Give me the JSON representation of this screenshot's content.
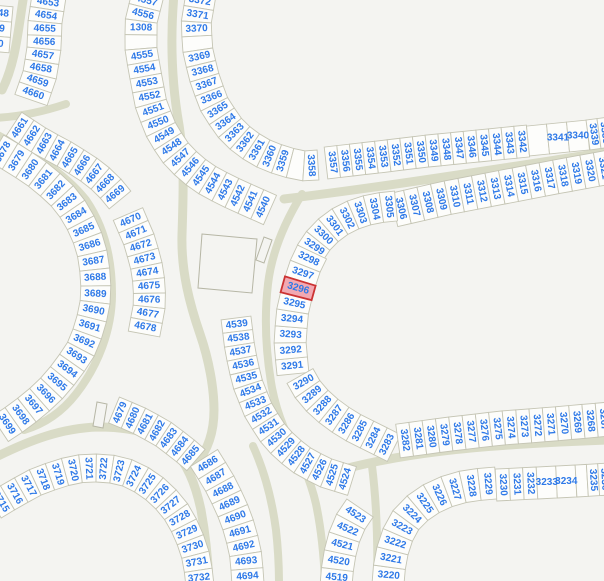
{
  "map": {
    "width": 604,
    "height": 581,
    "background": "#f4f4f1",
    "road_color": "#d9dbc6",
    "parcel_fill": "#fdfdfb",
    "parcel_stroke": "#c5c5b4",
    "label_color": "#2e79e8",
    "label_font_size": 10,
    "highlight": {
      "label": "3296",
      "fill": "#f2a9b2",
      "stroke": "#cc3333"
    },
    "structures": [
      {
        "name": "building-large",
        "points": "202,234 257,239 252,293 198,288"
      },
      {
        "name": "building-small-1",
        "points": "272,240 264,237 256,260 264,263"
      },
      {
        "name": "building-small-2",
        "points": "103,428 93,426 97,402 107,404"
      }
    ],
    "roads": [
      {
        "d": "M 24 -6 C 18 30 16 62 2 90",
        "w": 9
      },
      {
        "d": "M 66 104 C 42 112 18 117 -6 118",
        "w": 8
      },
      {
        "d": "M -8 132 C 30 152 64 172 86 200 C 104 226 112 258 112 294 C 112 330 98 366 76 394 C 62 412 44 424 24 430",
        "w": 8
      },
      {
        "d": "M -6 458 C 30 440 62 428 98 427 C 134 427 158 434 174 450 C 188 465 196 486 201 510 C 205 532 208 558 209 584",
        "w": 9
      },
      {
        "d": "M 253 446 C 264 470 272 500 276 530 C 278 548 279 566 279 584",
        "w": 8
      },
      {
        "d": "M 174 -6 C 170 40 172 85 179 125 C 185 163 183 200 182 235 C 181 272 190 305 200 334 C 209 360 214 388 214 410 C 214 432 208 450 196 464",
        "w": 9
      },
      {
        "d": "M 302 194 C 286 220 272 250 268 284 C 264 318 266 354 272 388 C 277 414 288 442 304 462 C 312 472 322 476 332 474",
        "w": 8
      },
      {
        "d": "M 326 474 C 400 452 480 446 560 442 L 608 440",
        "w": 9
      },
      {
        "d": "M 290 438 C 300 458 310 478 316 504 C 321 528 324 556 325 584",
        "w": 8
      },
      {
        "d": "M 372 466 C 376 498 378 540 377 584",
        "w": 8
      },
      {
        "d": "M 284 199 C 390 186 490 170 608 152",
        "w": 9
      }
    ],
    "rows": [
      {
        "name": "row-left-cut",
        "spine": [
          [
            4,
            6
          ],
          [
            0,
            52
          ]
        ],
        "hw": 9,
        "labels": [
          "48",
          "9",
          "0"
        ]
      },
      {
        "name": "row-4653-4660",
        "spine": [
          [
            49,
            -4
          ],
          [
            45,
            22
          ],
          [
            44,
            48
          ],
          [
            40,
            74
          ],
          [
            31,
            100
          ]
        ],
        "hw": 17,
        "labels": [
          "4653",
          "4654",
          "4655",
          "4656",
          "4657",
          "4658",
          "4659",
          "4660"
        ]
      },
      {
        "name": "row-4661-4669",
        "spine": [
          [
            14,
            124
          ],
          [
            40,
            141
          ],
          [
            66,
            155
          ],
          [
            88,
            169
          ],
          [
            106,
            183
          ],
          [
            120,
            200
          ]
        ],
        "hw": 14,
        "labels": [
          "4661",
          "4662",
          "4663",
          "4664",
          "4665",
          "4666",
          "4667",
          "4668",
          "4669"
        ]
      },
      {
        "name": "row-4670-4678",
        "spine": [
          [
            128,
            214
          ],
          [
            140,
            242
          ],
          [
            148,
            272
          ],
          [
            150,
            302
          ],
          [
            144,
            334
          ]
        ],
        "hw": 16,
        "labels": [
          "4670",
          "4671",
          "4672",
          "4673",
          "4674",
          "4675",
          "4676",
          "4677",
          "4678"
        ]
      },
      {
        "name": "row-4679-4685",
        "spine": [
          [
            114,
            410
          ],
          [
            138,
            420
          ],
          [
            162,
            433
          ],
          [
            182,
            448
          ],
          [
            196,
            460
          ]
        ],
        "hw": 14,
        "labels": [
          "4679",
          "4680",
          "4681",
          "4682",
          "4683",
          "4684",
          "4685"
        ]
      },
      {
        "name": "row-4686-4694",
        "spine": [
          [
            204,
            458
          ],
          [
            219,
            482
          ],
          [
            231,
            506
          ],
          [
            240,
            530
          ],
          [
            246,
            556
          ],
          [
            248,
            584
          ]
        ],
        "hw": 16,
        "labels": [
          "4686",
          "4687",
          "4688",
          "4689",
          "4690",
          "4691",
          "4692",
          "4693",
          "4694"
        ]
      },
      {
        "name": "row-4540-4557",
        "spine": [
          [
            148,
            -6
          ],
          [
            141,
            22
          ],
          [
            141,
            50
          ],
          [
            146,
            78
          ],
          [
            151,
            104
          ],
          [
            160,
            128
          ],
          [
            173,
            150
          ],
          [
            190,
            168
          ],
          [
            210,
            182
          ],
          [
            232,
            193
          ],
          [
            252,
            202
          ],
          [
            270,
            210
          ]
        ],
        "hw": 16,
        "labels": [
          "4557",
          "4556",
          "1308",
          "",
          "4555",
          "4554",
          "4553",
          "4552",
          "4551",
          "4550",
          "4549",
          "4548",
          "4547",
          "4546",
          "4545",
          "4544",
          "4543",
          "4542",
          "4541",
          "4540"
        ]
      },
      {
        "name": "row-3358-3372",
        "spine": [
          [
            201,
            -6
          ],
          [
            196,
            24
          ],
          [
            198,
            52
          ],
          [
            205,
            80
          ],
          [
            214,
            104
          ],
          [
            228,
            126
          ],
          [
            244,
            142
          ],
          [
            262,
            153
          ],
          [
            282,
            161
          ],
          [
            302,
            166
          ],
          [
            318,
            165
          ]
        ],
        "hw": 15,
        "labels": [
          "3372",
          "3371",
          "3370",
          "",
          "3369",
          "3368",
          "3367",
          "3366",
          "3365",
          "3364",
          "3363",
          "3362",
          "3361",
          "3360",
          "3359",
          "",
          "3358"
        ]
      },
      {
        "name": "row-3342-3357",
        "spine": [
          [
            326,
            163
          ],
          [
            378,
            157
          ],
          [
            428,
            151
          ],
          [
            478,
            146
          ],
          [
            528,
            141
          ]
        ],
        "hw": 16,
        "labels": [
          "3357",
          "3356",
          "3355",
          "3354",
          "3353",
          "3352",
          "3351",
          "3350",
          "3349",
          "3348",
          "3347",
          "3346",
          "3345",
          "3344",
          "3343",
          "3342"
        ]
      },
      {
        "name": "row-3340-3341",
        "spine": [
          [
            528,
            141
          ],
          [
            588,
            135
          ]
        ],
        "hw": 15,
        "labelAngle": 0,
        "labels": [
          "",
          "3341",
          "3340"
        ]
      },
      {
        "name": "row-3338-3339",
        "spine": [
          [
            588,
            135
          ],
          [
            610,
            132
          ]
        ],
        "hw": 15,
        "labels": [
          "3339",
          "3338"
        ]
      },
      {
        "name": "row-3306-3321",
        "spine": [
          [
            394,
            210
          ],
          [
            446,
            198
          ],
          [
            498,
            188
          ],
          [
            550,
            178
          ],
          [
            610,
            167
          ]
        ],
        "hw": 17,
        "labels": [
          "3306",
          "3307",
          "3308",
          "3309",
          "3310",
          "3311",
          "3312",
          "3313",
          "3314",
          "3315",
          "3316",
          "3317",
          "3318",
          "3319",
          "3320",
          "3321"
        ]
      },
      {
        "name": "row-3299-3305",
        "spine": [
          [
            310,
            253
          ],
          [
            320,
            238
          ],
          [
            334,
            225
          ],
          [
            350,
            216
          ],
          [
            368,
            210
          ],
          [
            384,
            207
          ],
          [
            396,
            206
          ]
        ],
        "hw": 15,
        "labels": [
          "3299",
          "3300",
          "3301",
          "3302",
          "3303",
          "3304",
          "3305"
        ]
      },
      {
        "name": "row-3291-3298",
        "spine": [
          [
            293,
            374
          ],
          [
            290,
            344
          ],
          [
            292,
            314
          ],
          [
            298,
            288
          ],
          [
            306,
            264
          ],
          [
            312,
            252
          ]
        ],
        "hw": 16,
        "labels": [
          "3291",
          "3292",
          "3293",
          "3294",
          "3295",
          "3296",
          "3297",
          "3298"
        ]
      },
      {
        "name": "row-3283-3290",
        "spine": [
          [
            394,
            448
          ],
          [
            374,
            438
          ],
          [
            354,
            428
          ],
          [
            336,
            417
          ],
          [
            320,
            404
          ],
          [
            308,
            390
          ],
          [
            300,
            376
          ]
        ],
        "hw": 15,
        "labels": [
          "3283",
          "3284",
          "3285",
          "3286",
          "3287",
          "3288",
          "3289",
          "3290"
        ]
      },
      {
        "name": "row-3267-3282",
        "spine": [
          [
            398,
            441
          ],
          [
            450,
            434
          ],
          [
            502,
            428
          ],
          [
            554,
            424
          ],
          [
            610,
            419
          ]
        ],
        "hw": 17,
        "labels": [
          "3282",
          "3281",
          "3280",
          "3279",
          "3278",
          "3277",
          "3276",
          "3275",
          "3274",
          "3273",
          "3272",
          "3271",
          "3270",
          "3269",
          "3268",
          "3267"
        ]
      },
      {
        "name": "row-3220-3229",
        "spine": [
          [
            388,
            584
          ],
          [
            390,
            560
          ],
          [
            396,
            538
          ],
          [
            407,
            518
          ],
          [
            423,
            503
          ],
          [
            442,
            493
          ],
          [
            462,
            487
          ],
          [
            482,
            484
          ],
          [
            496,
            483
          ]
        ],
        "hw": 16,
        "labels": [
          "3220",
          "3221",
          "3222",
          "3223",
          "3224",
          "3225",
          "3226",
          "3227",
          "3228",
          "3229"
        ]
      },
      {
        "name": "row-3230-3232",
        "spine": [
          [
            496,
            485
          ],
          [
            537,
            483
          ]
        ],
        "hw": 16,
        "labels": [
          "3230",
          "3231",
          "3232"
        ]
      },
      {
        "name": "row-3233-3234",
        "spine": [
          [
            537,
            483
          ],
          [
            576,
            481
          ]
        ],
        "hw": 16,
        "labelAngle": 0,
        "labels": [
          "3233",
          "3234"
        ]
      },
      {
        "name": "row-3235-3236",
        "spine": [
          [
            576,
            481
          ],
          [
            610,
            479
          ]
        ],
        "hw": 16,
        "labels": [
          "",
          "3235",
          "3236"
        ]
      },
      {
        "name": "row-4519-4523",
        "spine": [
          [
            336,
            586
          ],
          [
            338,
            562
          ],
          [
            343,
            540
          ],
          [
            351,
            521
          ],
          [
            360,
            508
          ]
        ],
        "hw": 16,
        "labels": [
          "4519",
          "4520",
          "4521",
          "4522",
          "4523"
        ]
      },
      {
        "name": "row-4524-4539",
        "spine": [
          [
            236,
            318
          ],
          [
            240,
            350
          ],
          [
            247,
            382
          ],
          [
            259,
            412
          ],
          [
            276,
            438
          ],
          [
            298,
            458
          ],
          [
            323,
            472
          ],
          [
            352,
            481
          ]
        ],
        "hw": 15,
        "labels": [
          "4539",
          "4538",
          "4537",
          "4536",
          "4535",
          "4534",
          "4533",
          "4532",
          "4531",
          "4530",
          "4529",
          "4528",
          "4527",
          "4526",
          "4525",
          "4524"
        ]
      },
      {
        "name": "row-3678-3699",
        "spine": [
          [
            -4,
            148
          ],
          [
            18,
            161
          ],
          [
            40,
            176
          ],
          [
            60,
            193
          ],
          [
            75,
            212
          ],
          [
            86,
            233
          ],
          [
            93,
            256
          ],
          [
            96,
            280
          ],
          [
            95,
            304
          ],
          [
            90,
            327
          ],
          [
            81,
            349
          ],
          [
            68,
            369
          ],
          [
            53,
            387
          ],
          [
            36,
            403
          ],
          [
            18,
            417
          ],
          [
            0,
            429
          ]
        ],
        "hw": 15,
        "labels": [
          "3678",
          "3679",
          "3680",
          "3681",
          "3682",
          "3683",
          "3684",
          "3685",
          "3686",
          "3687",
          "3688",
          "3689",
          "3690",
          "3691",
          "3692",
          "3693",
          "3694",
          "3695",
          "3696",
          "3697",
          "3698",
          "3699"
        ]
      },
      {
        "name": "row-3715-3732",
        "spine": [
          [
            -6,
            506
          ],
          [
            14,
            494
          ],
          [
            36,
            482
          ],
          [
            60,
            473
          ],
          [
            84,
            468
          ],
          [
            107,
            468
          ],
          [
            128,
            473
          ],
          [
            148,
            483
          ],
          [
            164,
            497
          ],
          [
            178,
            514
          ],
          [
            188,
            533
          ],
          [
            195,
            553
          ],
          [
            199,
            574
          ],
          [
            200,
            586
          ]
        ],
        "hw": 14,
        "labels": [
          "3715",
          "3716",
          "3717",
          "3718",
          "3719",
          "3720",
          "3721",
          "3722",
          "3723",
          "3724",
          "3725",
          "3726",
          "3727",
          "3728",
          "3729",
          "3730",
          "3731",
          "3732"
        ]
      }
    ]
  }
}
